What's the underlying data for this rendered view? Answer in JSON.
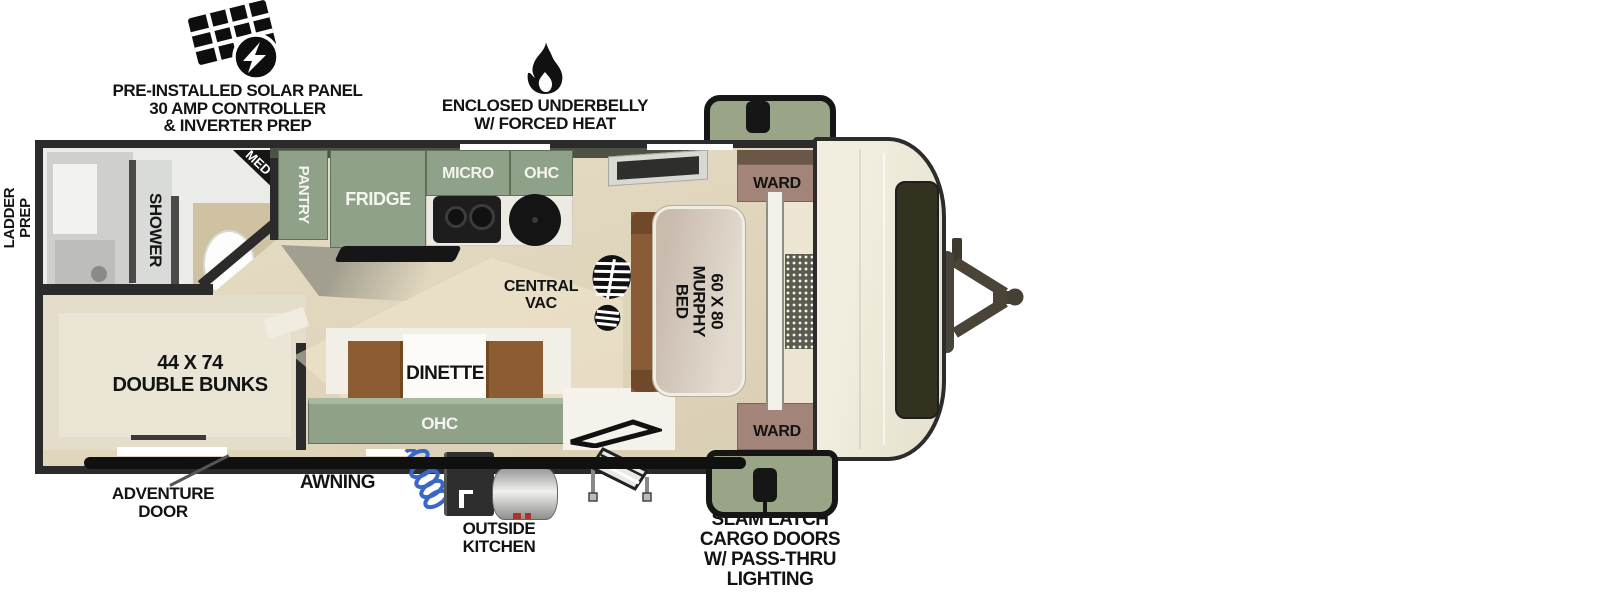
{
  "title": "Travel trailer floor plan",
  "colors": {
    "cabinet-green": "#8fa189",
    "wall-dark": "#2b2b2b",
    "ward-mauve": "#a28578",
    "ward-dark": "#6a5748",
    "cargo-green": "#9aa486",
    "floor-tan": "#e3dac2",
    "cap-cream": "#eeebdc",
    "bench-brown": "#8c5c33",
    "sofa-brown": "#8a5a36",
    "hose-blue": "#3a67c5",
    "ink": "#111111"
  },
  "callouts": {
    "solar": {
      "icon": "solar-panel-icon",
      "lines": [
        "PRE-INSTALLED SOLAR PANEL",
        "30 AMP CONTROLLER",
        "& INVERTER PREP"
      ]
    },
    "underbelly": {
      "icon": "flame-icon",
      "lines": [
        "ENCLOSED UNDERBELLY",
        "W/ FORCED HEAT"
      ]
    },
    "ladder_prep": {
      "lines": [
        "LADDER",
        "PREP"
      ]
    },
    "awning": "AWNING",
    "adventure_door": {
      "lines": [
        "ADVENTURE",
        "DOOR"
      ]
    },
    "outside_kitchen": {
      "lines": [
        "OUTSIDE",
        "KITCHEN"
      ]
    },
    "slam_latch": {
      "lines": [
        "SLAM LATCH",
        "CARGO DOORS",
        "W/ PASS-THRU",
        "LIGHTING"
      ]
    }
  },
  "rooms": {
    "bathroom": {
      "shower": "SHOWER",
      "med_cabinet": "MED"
    },
    "bunks": {
      "lines": [
        "44 X 74",
        "DOUBLE BUNKS"
      ]
    },
    "kitchen": {
      "pantry": "PANTRY",
      "fridge": "FRIDGE",
      "micro": "MICRO",
      "ohc": "OHC"
    },
    "central_vac": {
      "icon": "boot-print-icon",
      "lines": [
        "CENTRAL",
        "VAC"
      ]
    },
    "murphy_bed": {
      "lines": [
        "60 X 80",
        "MURPHY BED"
      ]
    },
    "wardrobe_front_top": "WARD",
    "wardrobe_front_bottom": "WARD",
    "dinette": {
      "label": "DINETTE",
      "ohc": "OHC"
    }
  }
}
